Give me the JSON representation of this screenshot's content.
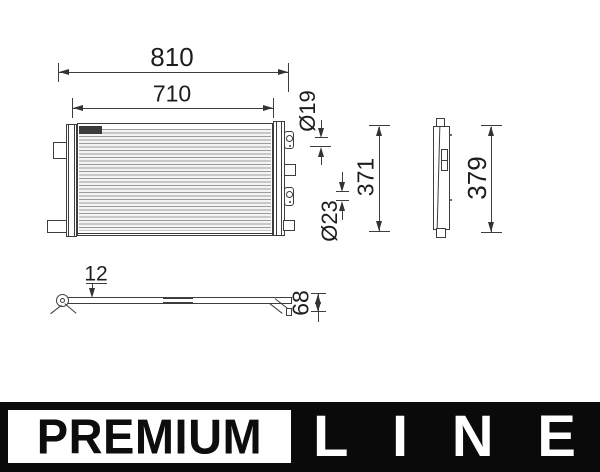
{
  "drawing": {
    "title": "Condenser technical drawing, three views",
    "dims": {
      "width_overall": "810",
      "width_core": "710",
      "port_top": "Ø19",
      "port_bottom": "Ø23",
      "height_inner": "371",
      "height_overall": "379",
      "depth_tab": "12",
      "depth_overall": "68"
    }
  },
  "logo": {
    "premium": "PREMIUM",
    "line_letters": [
      "L",
      "I",
      "N",
      "E"
    ]
  },
  "colors": {
    "line_art": "#3d3d3d",
    "dimension_text": "#1d1d1d",
    "logo_black": "#0a0a0a",
    "fin_hatch": "#9b9b9b",
    "label_block": "#3c3c3c"
  }
}
